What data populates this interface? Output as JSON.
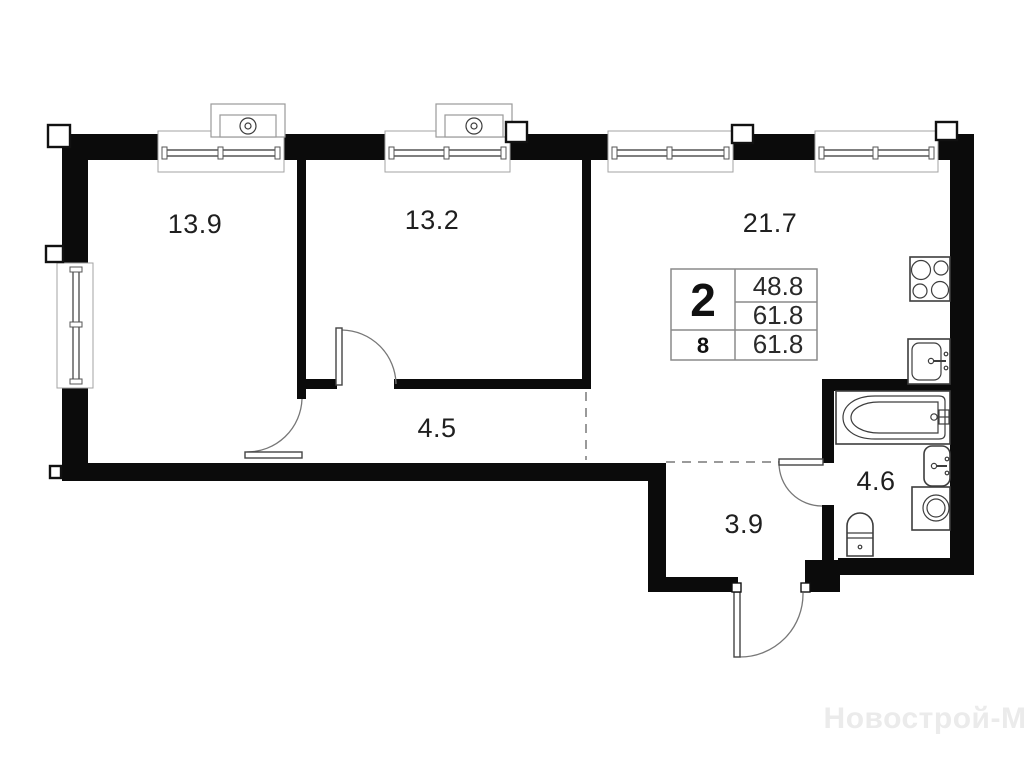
{
  "plan": {
    "rooms": [
      {
        "name": "bedroom-1",
        "area": "13.9"
      },
      {
        "name": "bedroom-2",
        "area": "13.2"
      },
      {
        "name": "living-kitchen",
        "area": "21.7"
      },
      {
        "name": "corridor",
        "area": "4.5"
      },
      {
        "name": "hall",
        "area": "3.9"
      },
      {
        "name": "bathroom",
        "area": "4.6"
      }
    ],
    "info_table": {
      "rooms_count": "2",
      "living_area": "48.8",
      "total_area": "61.8",
      "floor": "8",
      "floor_area": "61.8"
    },
    "watermark": "Новострой-М",
    "fixtures": [
      "air-conditioner",
      "air-conditioner",
      "stove",
      "kitchen-sink",
      "bathtub",
      "washbasin",
      "washing-machine",
      "toilet"
    ],
    "colors": {
      "wall": "#0b0b0b",
      "fixture_line": "#3d3d3d",
      "dashed_zone_line": "#9a9a9a",
      "watermark": "#ebebeb"
    }
  }
}
